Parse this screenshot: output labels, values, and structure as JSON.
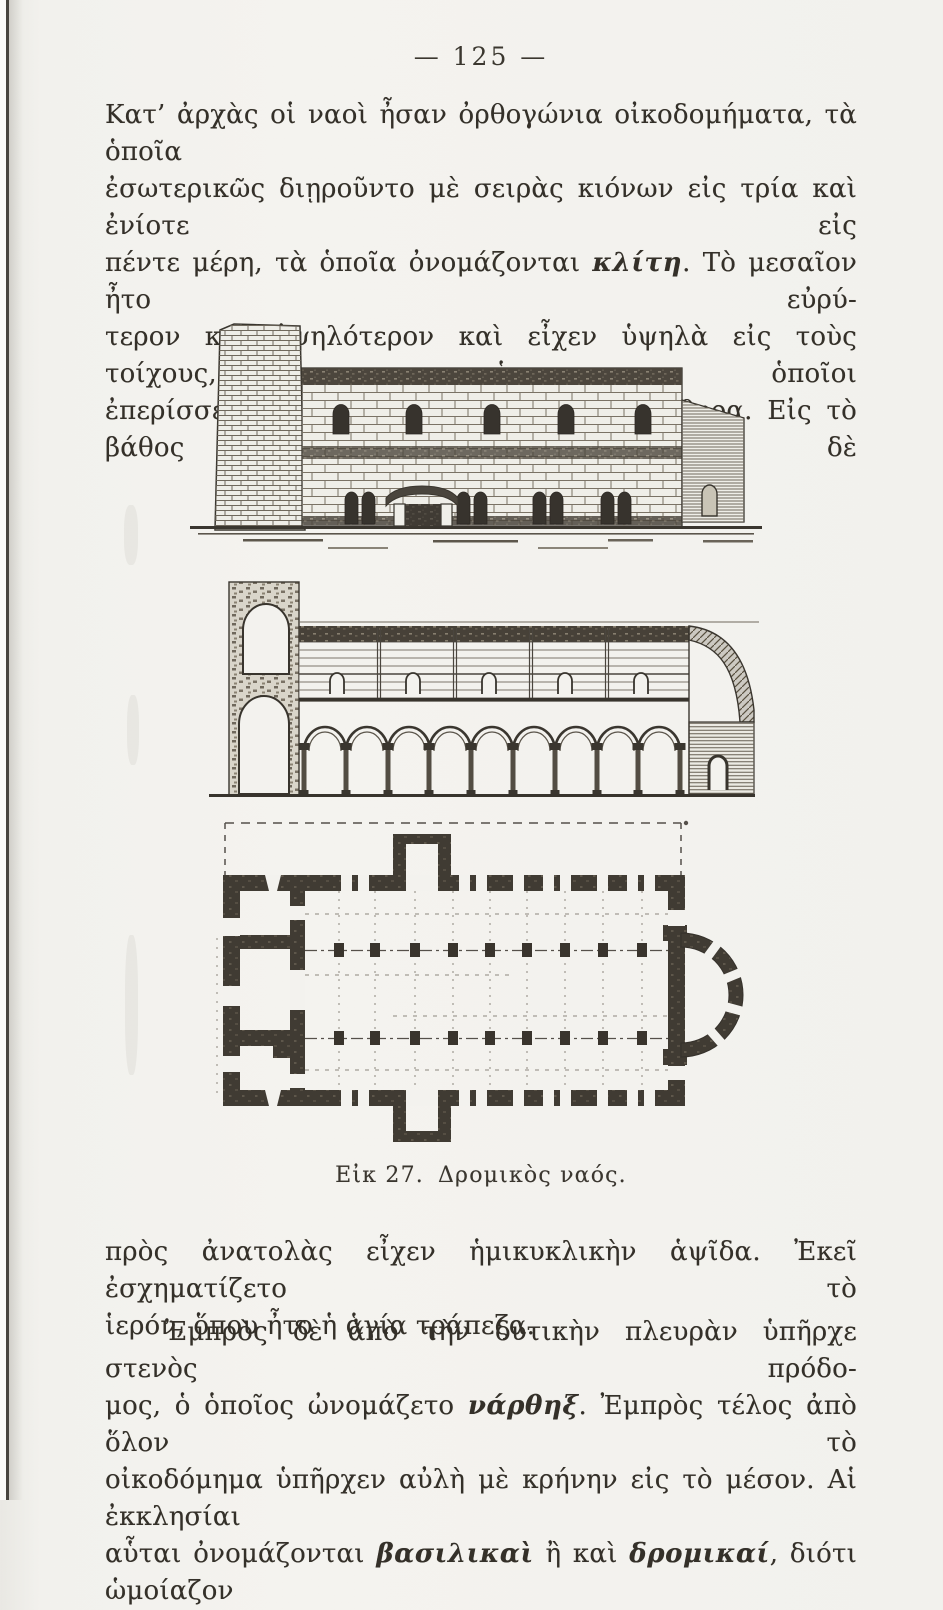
{
  "page": {
    "number": "— 125 —"
  },
  "paragraphs": [
    {
      "lines": [
        {
          "runs": [
            {
              "text": "Κατ’ ἀρχὰς οἱ ναοὶ ἦσαν ὀρθογώνια οἰκοδομήματα, τὰ ὁποῖα"
            }
          ]
        },
        {
          "runs": [
            {
              "text": "ἐσωτερικῶς διῃροῦντο μὲ σειρὰς κιόνων εἰς τρία καὶ ἐνίοτε εἰς"
            }
          ]
        },
        {
          "runs": [
            {
              "text": "πέντε μέρη, τὰ ὁποῖα ὀνομάζονται "
            },
            {
              "text": "κλίτη"
            },
            {
              "text": ". Τὸ μεσαῖον ἦτο εὐρύ-"
            }
          ]
        },
        {
          "runs": [
            {
              "text": "τερον καὶ ὑψηλότερον καὶ εἶχεν ὑψηλὰ εἰς τοὺς τοίχους, οἱ ὁποῖοι"
            }
          ]
        },
        {
          "runs": [
            {
              "text": "ἐπερίσσευαν ἀπὸ τὰ πλάγια κλίτη, παράθυρα. Εἰς τὸ βάθος δὲ"
            }
          ]
        }
      ]
    },
    {
      "lines": [
        {
          "runs": [
            {
              "text": "πρὸς ἀνατολὰς εἶχεν ἡμικυκλικὴν ἁψῖδα. Ἐκεῖ ἐσχηματίζετο τὸ"
            }
          ]
        },
        {
          "runs": [
            {
              "text": "ἱερόν, ὅπου ἦτο ἡ ἁγία τράπεζα."
            }
          ]
        }
      ]
    },
    {
      "lines": [
        {
          "runs": [
            {
              "text": "Ἐμπρὸς δὲ ἀπὸ τὴν δυτικὴν πλευρὰν ὑπῆρχε στενὸς πρόδο-"
            }
          ]
        },
        {
          "runs": [
            {
              "text": "μος, ὁ ὁποῖος ὠνομάζετο "
            },
            {
              "text": "νάρθηξ"
            },
            {
              "text": ". Ἐμπρὸς τέλος ἀπὸ ὅλον τὸ"
            }
          ]
        },
        {
          "runs": [
            {
              "text": "οἰκοδόμημα ὑπῆρχεν αὐλὴ μὲ κρήνην εἰς τὸ μέσον. Αἱ ἐκκλησίαι"
            }
          ]
        },
        {
          "runs": [
            {
              "text": "αὗται ὀνομάζονται "
            },
            {
              "text": "βασιλικαὶ"
            },
            {
              "text": " ἢ καὶ "
            },
            {
              "text": "δρομικαί"
            },
            {
              "text": ", διότι ὡμοίαζον"
            }
          ]
        }
      ]
    }
  ],
  "figure": {
    "caption_label": "Εἰκ 27.",
    "caption_title": "Δρομικὸς ναός."
  },
  "colors": {
    "paper": "#f3f2ee",
    "ink": "#35312b"
  }
}
